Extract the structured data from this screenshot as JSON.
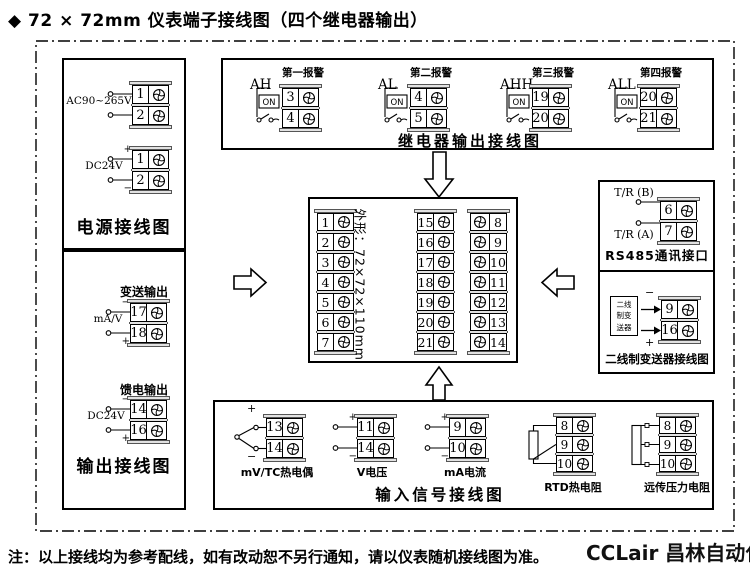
{
  "title": "◆ 72 × 72mm 仪表端子接线图（四个继电器输出）",
  "note": "注：以上接线均为参考配线，如有改动恕不另行通知，请以仪表随机接线图为准。",
  "brand": "CCLair 昌林自动化",
  "power_box": {
    "label": "电源接线图",
    "groups": [
      {
        "name": "AC90~265V",
        "terminals": [
          "1",
          "2"
        ],
        "lead_top": "",
        "lead_bottom": ""
      },
      {
        "name": "DC24V",
        "terminals": [
          "1",
          "2"
        ],
        "lead_top": "+",
        "lead_bottom": "−"
      }
    ]
  },
  "output_box": {
    "label": "输出接线图",
    "groups": [
      {
        "title": "变送输出",
        "name": "mA/V",
        "terminals": [
          "17",
          "18"
        ],
        "lead_top": "−",
        "lead_bottom": "+"
      },
      {
        "title": "馈电输出",
        "name": "DC24V",
        "terminals": [
          "14",
          "16"
        ],
        "lead_top": "−",
        "lead_bottom": "+"
      }
    ]
  },
  "relay_box": {
    "label": "继电器输出接线图",
    "switch_label": "ON",
    "alarms": [
      {
        "title": "第一报警",
        "name": "AH",
        "terminals": [
          "3",
          "4"
        ]
      },
      {
        "title": "第二报警",
        "name": "AL",
        "terminals": [
          "4",
          "5"
        ]
      },
      {
        "title": "第三报警",
        "name": "AHH",
        "terminals": [
          "19",
          "20"
        ]
      },
      {
        "title": "第四报警",
        "name": "ALL",
        "terminals": [
          "20",
          "21"
        ]
      }
    ]
  },
  "center_box": {
    "outline_label": "外形：72×72×110mm",
    "left_column": [
      "1",
      "2",
      "3",
      "4",
      "5",
      "6",
      "7"
    ],
    "middle_column": [
      "15",
      "16",
      "17",
      "18",
      "19",
      "20",
      "21"
    ],
    "right_column": [
      "8",
      "9",
      "10",
      "11",
      "12",
      "13",
      "14"
    ]
  },
  "rs485_box": {
    "label": "RS485通讯接口",
    "line_b": "T/R (B)",
    "line_a": "T/R (A)",
    "terminals": [
      "6",
      "7"
    ]
  },
  "transmitter_box": {
    "label": "二线制变送器接线图",
    "device_lines": [
      "二线",
      "制变",
      "送器"
    ],
    "polarity_top": "−",
    "polarity_bottom": "+",
    "terminals": [
      "9",
      "16"
    ]
  },
  "input_box": {
    "label": "输入信号接线图",
    "inputs": [
      {
        "name": "mV/TC热电偶",
        "terminals": [
          "13",
          "14"
        ],
        "lead_top": "+",
        "lead_bottom": "−"
      },
      {
        "name": "V电压",
        "terminals": [
          "11",
          "14"
        ],
        "lead_top": "+",
        "lead_bottom": "−"
      },
      {
        "name": "mA电流",
        "terminals": [
          "9",
          "10"
        ],
        "lead_top": "+",
        "lead_bottom": "−"
      }
    ],
    "resistor_inputs": [
      {
        "name": "RTD热电阻",
        "terminals": [
          "8",
          "9",
          "10"
        ]
      },
      {
        "name": "远传压力电阻",
        "terminals": [
          "8",
          "9",
          "10"
        ]
      }
    ]
  }
}
